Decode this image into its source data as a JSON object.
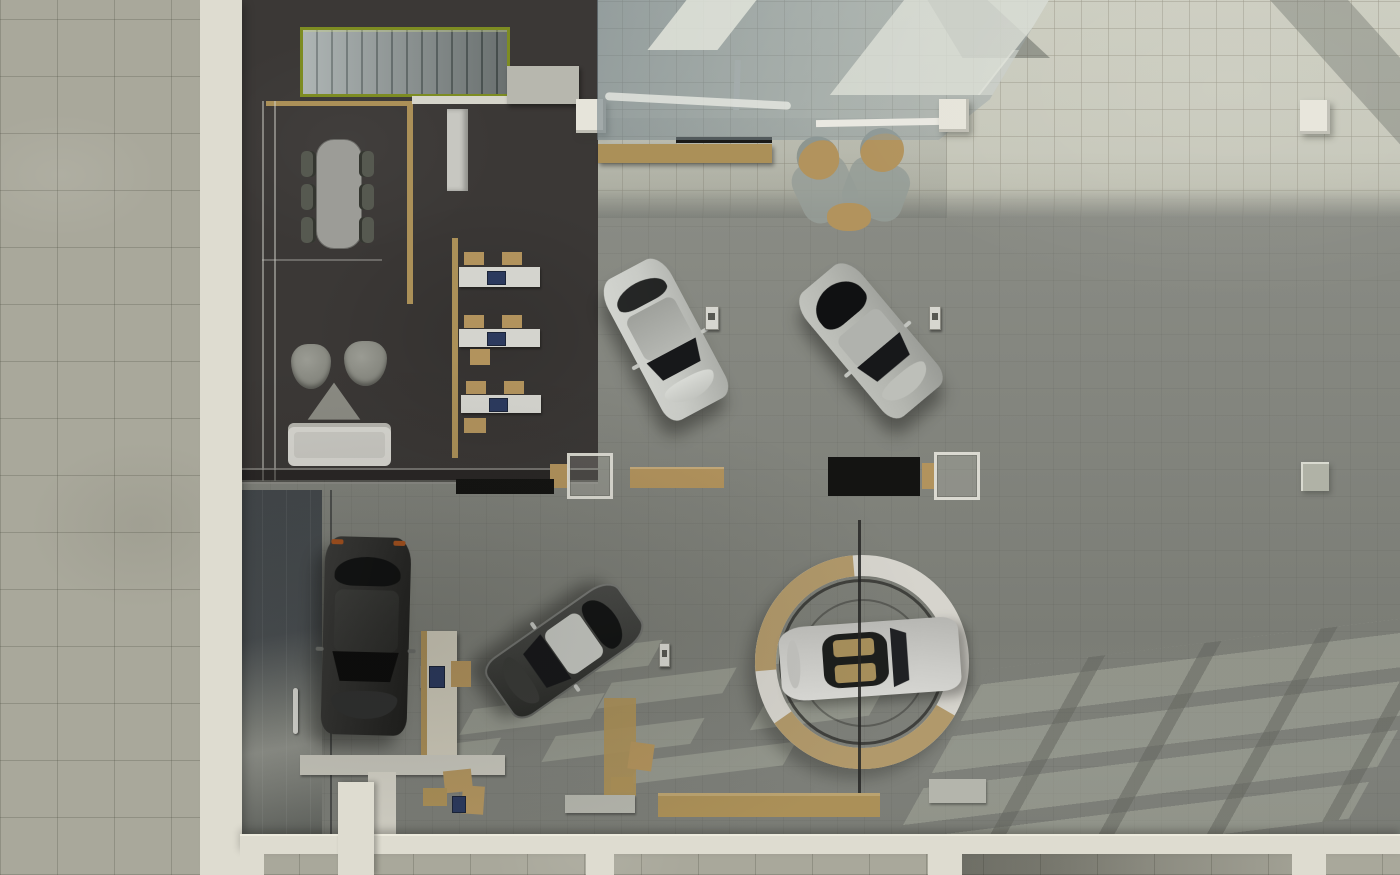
{
  "scene": {
    "description": "Top-down 3D architectural rendering of a car dealership showroom interior",
    "view": "overhead plan render",
    "zones": [
      "sidewalk",
      "office-and-lounge",
      "reception-under-mezzanine",
      "showroom-floor",
      "storefront"
    ],
    "vehicle_count": 5
  },
  "palette": {
    "pavement": "#a9a89b",
    "wall": "#dedcd0",
    "office_floor": "#3b3836",
    "stair_green": "#7d8c22",
    "wood": "#ab9058",
    "floor_bright": "#c6c7ba",
    "floor_mid": "#8b8d85",
    "desk_white": "#d4d4ce",
    "monitor_navy": "#2c3a5e",
    "chair_tan": "#b2935d",
    "chair_gray": "#565950",
    "sofa_white": "#d7d6d0",
    "car_white": "#c9cbc6",
    "car_silver": "#b4b6b0",
    "car_dark": "#2c2c2a",
    "car_sedan": "#3f403d",
    "turntable_ring": "#d6d4cd",
    "turntable_wood": "#b1996b",
    "mat_black": "#141412",
    "column_white": "#e6e4da",
    "light_patch": "rgba(176,180,165,0.45)"
  },
  "objects": [
    {
      "id": "sidewalk",
      "label": "Concrete tile sidewalk"
    },
    {
      "id": "exterior-wall",
      "label": "White exterior wall"
    },
    {
      "id": "staircase",
      "label": "Staircase with lime-green guardrail"
    },
    {
      "id": "meeting-table",
      "label": "Meeting table with six chairs"
    },
    {
      "id": "staff-desks",
      "label": "Three staff desks with monitors and tan chairs",
      "count": 3
    },
    {
      "id": "lounge",
      "label": "Lounge with sofa, two armchairs and triangular coffee table"
    },
    {
      "id": "reception",
      "label": "Wooden reception counter with tan stools"
    },
    {
      "id": "mezzanine-glass",
      "label": "Glass mezzanine overhang with skylight reflections"
    },
    {
      "id": "turntable",
      "label": "Circular car turntable with wood trim segments"
    },
    {
      "id": "car-white-suv",
      "label": "White SUV displayed diagonally"
    },
    {
      "id": "car-silver-suv",
      "label": "Silver SUV displayed diagonally"
    },
    {
      "id": "car-dark-suv",
      "label": "Black SUV parked vertically"
    },
    {
      "id": "car-dark-sedan",
      "label": "Dark sedan parked diagonally"
    },
    {
      "id": "car-convertible",
      "label": "White convertible on turntable"
    },
    {
      "id": "columns",
      "label": "White structural columns"
    },
    {
      "id": "display-mats",
      "label": "Black display floor mats"
    },
    {
      "id": "benches",
      "label": "Wooden benches and service counters"
    },
    {
      "id": "sign-stands",
      "label": "Small vehicle sign stands"
    },
    {
      "id": "entry-door",
      "label": "Glass entry door with handle"
    },
    {
      "id": "storefront",
      "label": "Storefront wall with white mullions"
    },
    {
      "id": "skylight-shadows",
      "label": "Sunlight grid patterns cast on floor"
    }
  ]
}
